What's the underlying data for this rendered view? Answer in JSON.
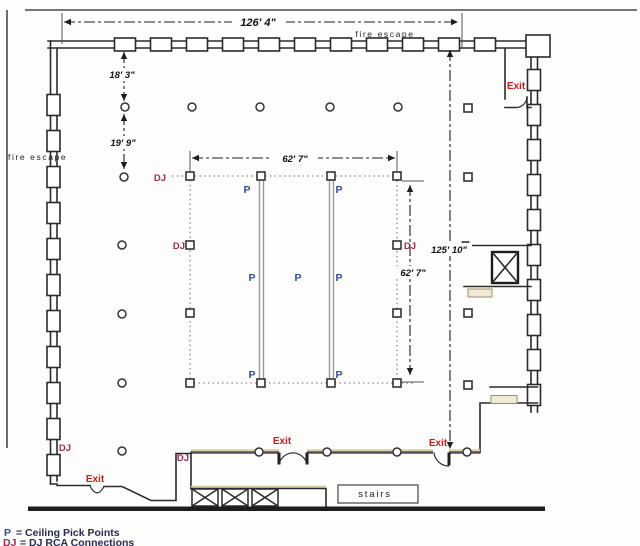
{
  "colors": {
    "pick_point": "#2e4f95",
    "dj_connection": "#a02a55",
    "exit": "#cc1d1d",
    "ink": "#2b2b2b",
    "legend_text": "#272c52"
  },
  "labels": {
    "fire_escape": "fire escape",
    "stairs": "stairs",
    "exit": "Exit",
    "pick_point": "P",
    "dj": "DJ"
  },
  "dimensions": {
    "top_width": "126' 4\"",
    "upper_left_bay": "18' 3\"",
    "second_left_bay": "19' 9\"",
    "rig_width": "62' 7\"",
    "rig_height": "62' 7\"",
    "hall_depth": "125' 10\""
  },
  "legend": {
    "pick_symbol": "P",
    "pick_label": "= Ceiling Pick Points",
    "dj_symbol": "DJ",
    "dj_label": "= DJ RCA Connections"
  }
}
